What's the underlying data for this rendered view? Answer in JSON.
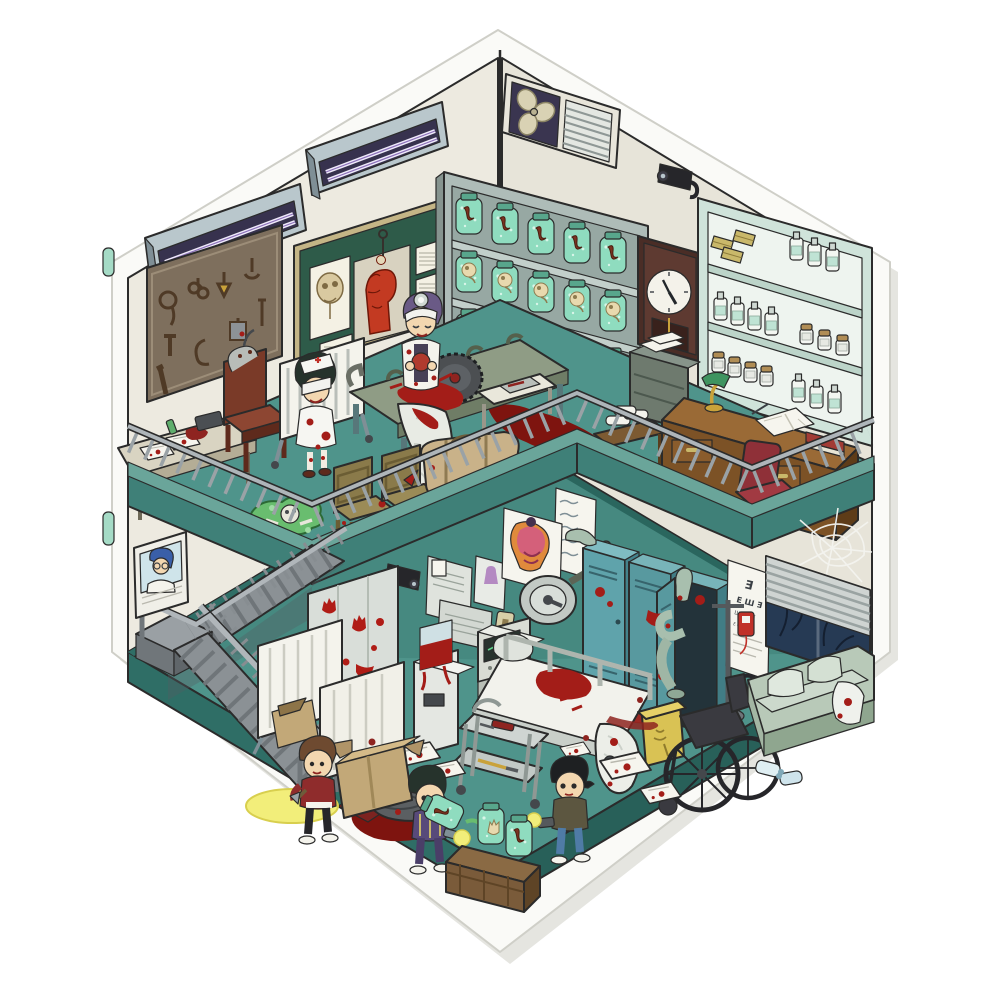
{
  "scene": {
    "title": "Haunted hospital isometric diorama sticker",
    "type": "two-story cutaway illustration, no UI text",
    "upper_floor": "operating theater / specimen room mezzanine",
    "lower_floor": "abandoned hospital ward explored by three kids with flashlights"
  },
  "labels": {
    "sticker": "die-cut sticker base",
    "left_wall": "left wall",
    "right_wall": "right wall",
    "ceiling_lamp_1": "fluorescent light fixture",
    "ceiling_lamp_2": "fluorescent light fixture",
    "tool_board": "board of torture tools (whip, shackles, sickle, cleaver, knives)",
    "anatomy_board": "green board with skull and muscle-head anatomy posters",
    "fan_vent": "wall fan and louvered vent",
    "camera_upper": "security camera",
    "specimen_shelf": "shelf of green specimen jars (embryos, limbs, organs)",
    "wall_clock": "dark wooden pendulum wall clock",
    "medicine_cabinet": "mint medicine cabinet with bottles and boxes",
    "filing_cabinet": "metal filing cabinet with papers",
    "doctor_desk": "wooden desk with banker lamp, open journal and red book",
    "red_chair": "red upholstered chair",
    "bandage_table": "side table with bandage rolls",
    "blood_pool": "pool of blood on mezzanine floor",
    "autopsy_desk": "table with bloodstained documents, typewriter and flask",
    "electric_chair": "wooden electric chair with head cap",
    "gurney": "white slatted hospital cot",
    "nurse": "blindfolded nurse in bloodstained uniform",
    "surgeon": "surgeon with head mirror and bandages holding an organ",
    "operating_table": "operating table with blood and draped sheet",
    "bone_saw": "circular bone saw blade",
    "side_table": "instrument side table with scalpel tray",
    "wooden_chair_1": "wooden chair",
    "wooden_chair_2": "wooden chair",
    "duffel_bag": "canvas duffel bag",
    "remains_pile": "green slime with skeletal remains",
    "railing": "mezzanine guard railing",
    "staircase": "steel switchback staircase",
    "portrait": "framed portrait of a blue-haired doctor",
    "camera_lower": "security camera",
    "notice_boards": "notice boards with documents and patient photo",
    "vitals_chart": "wall chart with scribbled vitals",
    "torso_poster": "anatomical torso poster",
    "bloody_glass": "glass partition with bloody handprints",
    "privacy_screen_1": "folding privacy screen",
    "privacy_screen_2": "folding privacy screen",
    "surgical_lamp": "articulated surgical lamp",
    "light_switch": "light switch",
    "lockers": "teal lockers with zombie limbs emerging",
    "zombie": "zombie hiding in locker",
    "eye_chart": "tumbling-E eye test chart",
    "iv_stand": "IV stand with blood bag",
    "spider_web": "spider web",
    "window": "night window with venetian blinds and bare branches",
    "sofa": "pale green sofa with pillows and bloodied blanket",
    "wheelchair": "black wheelchair",
    "sharps_bin": "yellow sharps bin",
    "instrument_cart": "steel instrument trolley",
    "water_cooler": "water cooler filled with blood",
    "vitals_monitor": "medical monitor with green trace",
    "supply_unit": "medical supply unit",
    "hospital_bed": "hospital bed with blood and trailing sheet",
    "papers": "scattered bloodstained papers",
    "tarp_body": "body under a tarp with blood pool",
    "box_large": "opened cardboard box",
    "box_small": "small cardboard box",
    "specimen_crate": "wooden crate with specimen jars",
    "tipped_jar": "tipped-over specimen jar",
    "boy_red_jacket": "boy in red jacket with hatchet and flashlight",
    "girl_pajamas": "girl in striped pajamas with flashlight",
    "boy_jeans": "boy in jeans with flashlight",
    "water_bottles": "discarded water bottles",
    "flashlight_pool": "flashlight beam on floor"
  },
  "eye_chart": {
    "rows": [
      "Ǝ",
      "E Ш Ǝ",
      "Ш E Ǝ E",
      "E Ǝ Ш Ǝ E"
    ]
  },
  "clock": {
    "time": "4:55"
  },
  "palette": {
    "wall": "#edeae0",
    "wall_line": "#2b2b2b",
    "floor": "#4f948b",
    "floor_side": "#2f6e66",
    "fascia": "#3f8078",
    "fascia_lip": "#6aa59a",
    "railing": "#9aa2a6",
    "stair": "#8b9195",
    "sticker": "#fafaf7",
    "shadow": "#dcdcd6",
    "tab": "#a5dbc6",
    "blood": "#a31d18",
    "dark_blood": "#7e140f",
    "jar": "#8fdcbf",
    "locker": "#5fa3ab",
    "wood": "#8a5a2e",
    "chalk_green": "#2e5b49",
    "board_brown": "#7e6f5d",
    "navy": "#3a3550",
    "bin_yellow": "#d9c254",
    "sofa": "#ccd9cc",
    "lamp_green": "#3f9460",
    "night": "#263a54"
  }
}
